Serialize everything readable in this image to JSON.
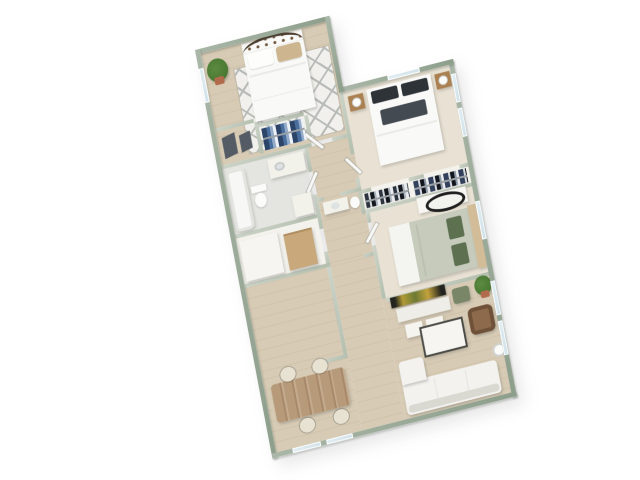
{
  "scene": {
    "title": "3D isometric floor plan of a two-bath multi-bedroom apartment, viewed from above on a white background",
    "type": "3d-floor-plan",
    "visible_text": "none"
  },
  "palette": {
    "wall": "#aab7a8",
    "wallD": "#8d9e8b",
    "iwall": "#cdd4c9",
    "iwallD": "#b4bfaf",
    "floorWood": "#d7cbb5",
    "floorCarpet": "#e9e2d4",
    "floorTile": "#e4e4e0",
    "closetFloor": "#f4f2ec",
    "glass": "#cfe1e8",
    "counter": "#f2f1ea",
    "stove": "#26272b",
    "burner": "#5a5d63",
    "tableWood": "#b79a79",
    "grain": "#a8896a",
    "chair": "#e8e2d2",
    "sofa": "#f3f2ee",
    "sofaLine": "#d9d8d1",
    "coffeeTop": "#f6f5f1",
    "coffeeBase": "#4a4a45",
    "armchair": "#8d6a4b",
    "armchairD": "#6e5138",
    "tv": "#23241f",
    "tvGlow": "#c3a23c",
    "consoleW": "#efede7",
    "green1": "#5c8a40",
    "green2": "#40702c",
    "pot": "#b26a4c",
    "bedW": "#f9f9f7",
    "pillowTan": "#cdb68f",
    "pillowDk": "#2e3338",
    "throwDk": "#434a52",
    "duvetSage": "#c6cbbc",
    "pillowGr": "#5d7150",
    "hbTan": "#d3bd98",
    "hbMetal": "#4a3a2a",
    "wood": "#ab8152",
    "lamp": "#fbfbfa",
    "rug": "#f1f0ec",
    "rugLn": "#b7bab6",
    "rod": "#9aa0a4",
    "blue1": "#2c4468",
    "blue2": "#4a6f9e",
    "blue3": "#93abc9",
    "dk1": "#2b333f",
    "dk2": "#12161d",
    "lt1": "#d6dade",
    "mirror": "#1f1f1f",
    "art": "#555b64",
    "shelf": "#c9a87b",
    "door": "#f8f8f6",
    "accentChair": "#7a8668"
  },
  "rooms": [
    {
      "id": "bedroom-1",
      "label": "Bedroom 1",
      "furniture": [
        "metal scroll-headboard bed with white duvet",
        "white and tan pillows",
        "potted plant",
        "white diamond-pattern area rug",
        "pair of dark wall-art panels",
        "closet with gray garments",
        "closet with blue hanging clothes"
      ],
      "windows": 1
    },
    {
      "id": "bedroom-2",
      "label": "Bedroom 2",
      "furniture": [
        "bed with white duvet and charcoal pillows",
        "dark gray throw",
        "two wood nightstands",
        "two white table lamps",
        "double reach-in closet with hanging clothes"
      ],
      "windows": 3
    },
    {
      "id": "bedroom-3",
      "label": "Bedroom 3",
      "furniture": [
        "bed with sage duvet and tan headboard",
        "green accent pillows",
        "white dresser with black oval mirror"
      ],
      "windows": 1
    },
    {
      "id": "bathroom-1",
      "label": "Bathroom",
      "furniture": [
        "bathtub",
        "toilet",
        "vanity with sink",
        "storage cabinet"
      ],
      "windows": 0
    },
    {
      "id": "bathroom-2",
      "label": "Second bath / hall closet",
      "furniture": [
        "vanity",
        "toilet",
        "tan shelving unit",
        "white storage closet"
      ],
      "windows": 0
    },
    {
      "id": "kitchen",
      "label": "Galley Kitchen",
      "furniture": [
        "left counter with sink",
        "right counter with black 4-burner range"
      ],
      "windows": 0
    },
    {
      "id": "dining-area",
      "label": "Dining Area",
      "furniture": [
        "rectangular wood dining table",
        "four cream upholstered chairs"
      ],
      "windows": 2
    },
    {
      "id": "living-room",
      "label": "Living Room",
      "furniture": [
        "wall tv",
        "white media console",
        "two white ottomans",
        "green accent chair",
        "potted plant",
        "white coffee table with dark base",
        "brown leather armchair",
        "white sofa with chaise",
        "floor lamp"
      ],
      "windows": 2
    }
  ],
  "style_notes": {
    "wall_top_color_name": "sage green-gray",
    "floor_material": "light oak plank",
    "view": "rotated ~17 degrees, axonometric dollhouse view"
  }
}
